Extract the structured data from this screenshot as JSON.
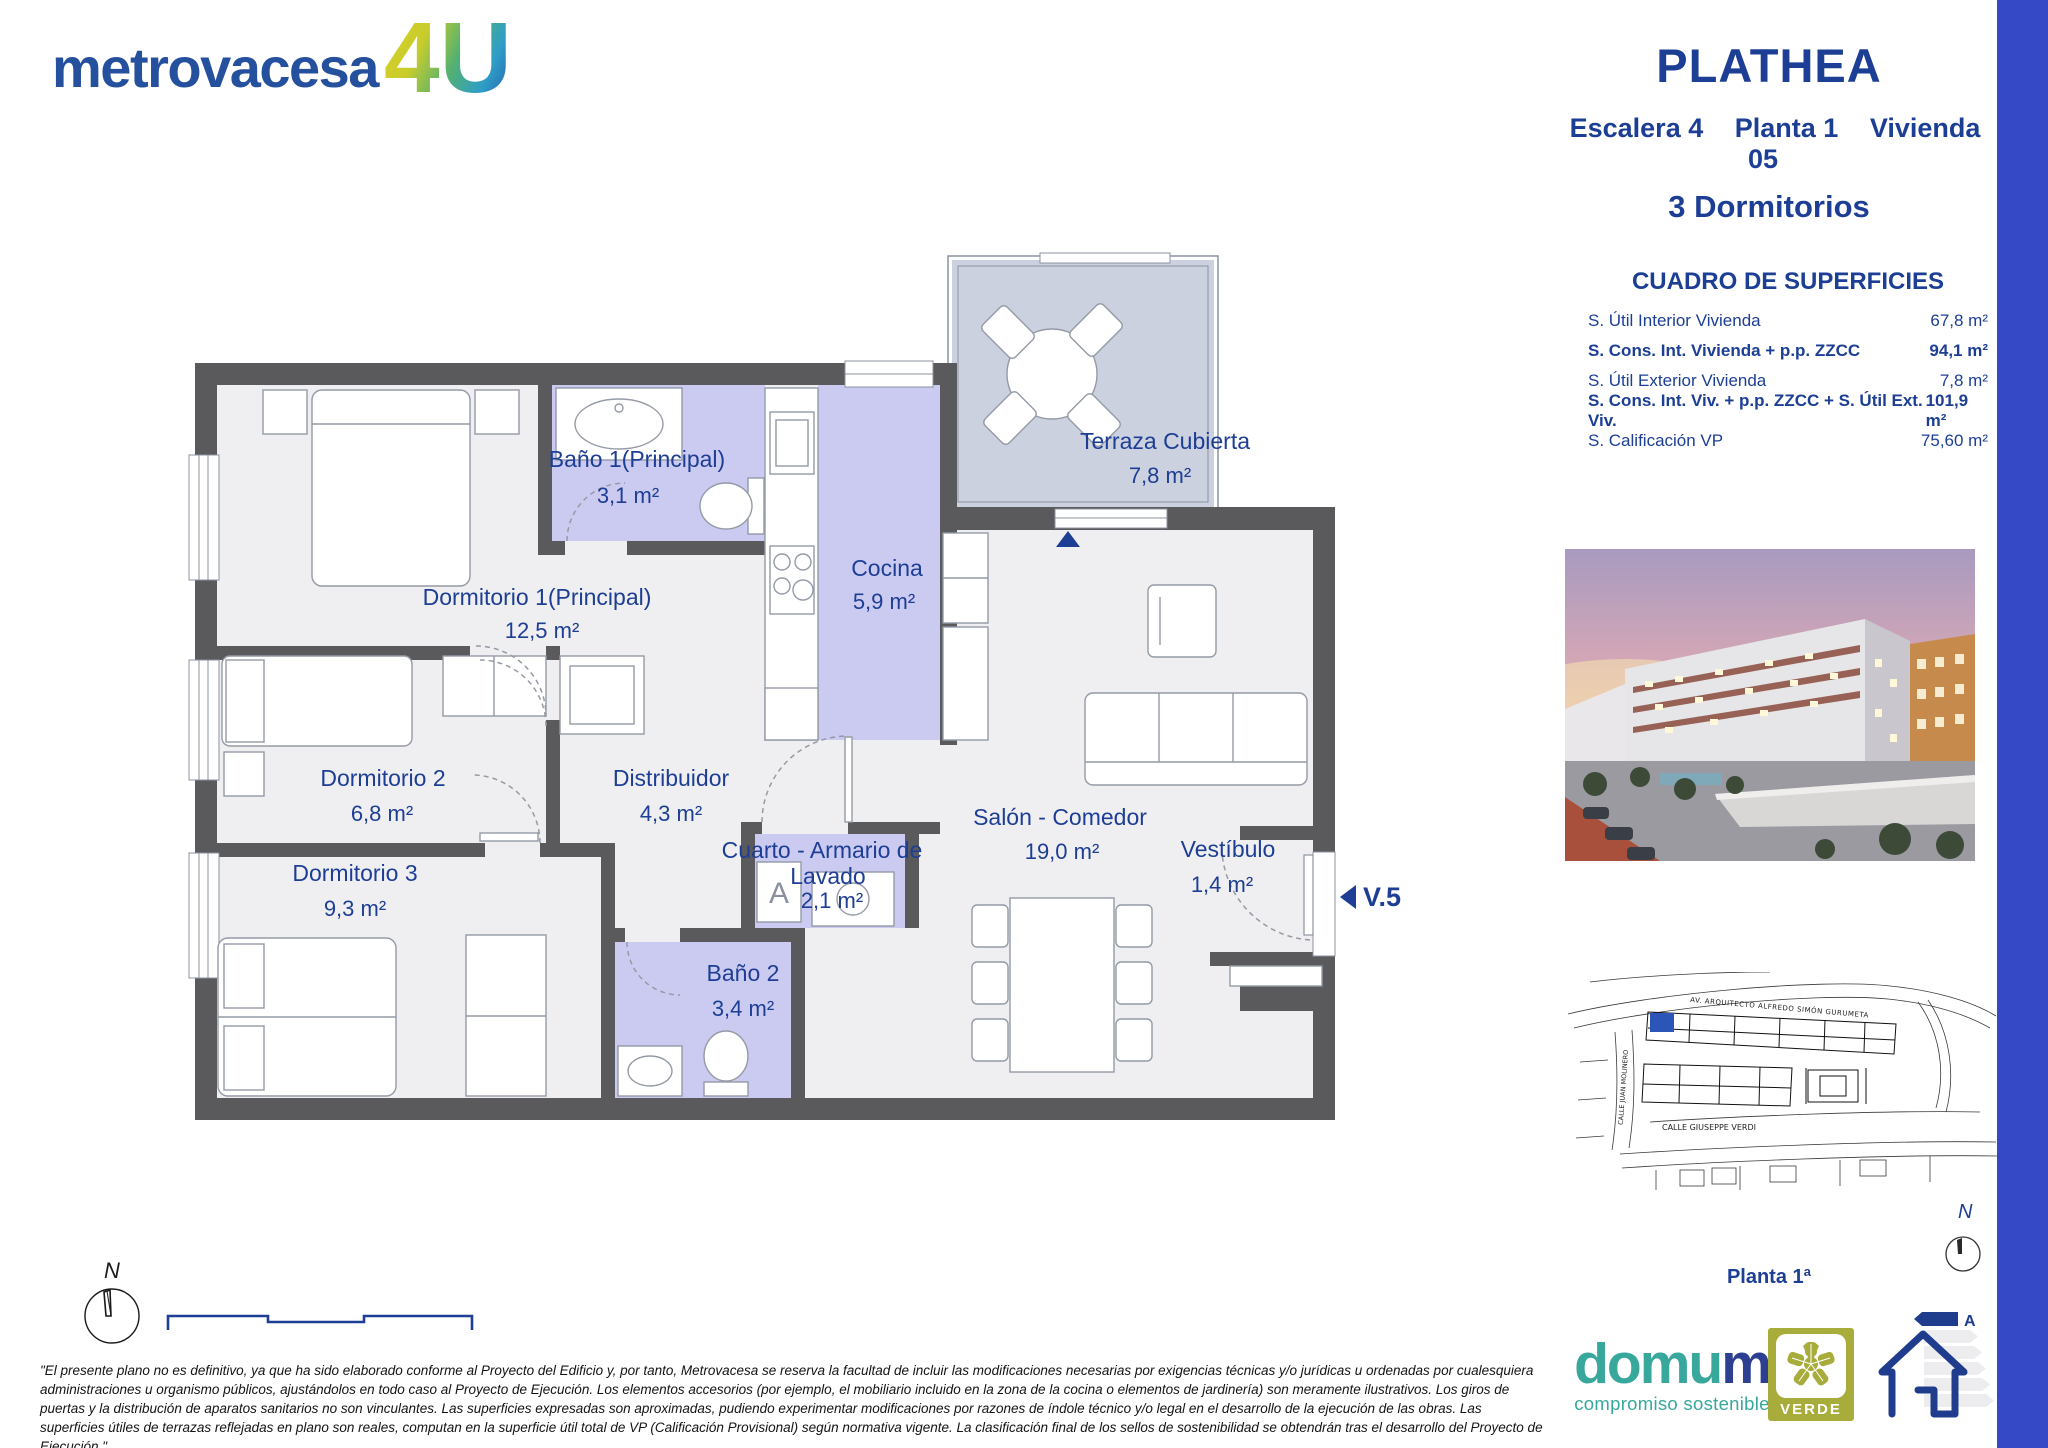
{
  "brand": {
    "name": "metrovacesa",
    "suffix": "4U"
  },
  "header": {
    "project_title": "PLATHEA",
    "escalera": "Escalera 4",
    "planta": "Planta 1",
    "vivienda": "Vivienda 05",
    "bedrooms": "3 Dormitorios"
  },
  "surfaces": {
    "title": "CUADRO DE SUPERFICIES",
    "rows": [
      {
        "label": "S. Útil Interior Vivienda",
        "value": "67,8 m²"
      },
      {
        "label": "S. Cons. Int. Vivienda + p.p. ZZCC",
        "value": "94,1 m²"
      },
      {
        "label": "S. Útil Exterior Vivienda",
        "value": "7,8 m²"
      },
      {
        "label": "S. Cons. Int. Viv. + p.p. ZZCC + S. Útil Ext. Viv.",
        "value": "101,9 m²"
      },
      {
        "label": "S. Calificación VP",
        "value": "75,60 m²"
      }
    ]
  },
  "floorplan": {
    "rooms": [
      {
        "id": "dormitorio-1",
        "lines": [
          "Dormitorio 1(Principal)"
        ],
        "area": "12,5 m²"
      },
      {
        "id": "bano-1",
        "lines": [
          "Baño 1(Principal)"
        ],
        "area": "3,1 m²"
      },
      {
        "id": "terraza",
        "lines": [
          "Terraza Cubierta"
        ],
        "area": "7,8 m²"
      },
      {
        "id": "cocina",
        "lines": [
          "Cocina"
        ],
        "area": "5,9 m²"
      },
      {
        "id": "dormitorio-2",
        "lines": [
          "Dormitorio 2"
        ],
        "area": "6,8 m²"
      },
      {
        "id": "distribuidor",
        "lines": [
          "Distribuidor"
        ],
        "area": "4,3 m²"
      },
      {
        "id": "dormitorio-3",
        "lines": [
          "Dormitorio 3"
        ],
        "area": "9,3 m²"
      },
      {
        "id": "cuarto-lavado",
        "lines": [
          "Cuarto - Armario de",
          "Lavado"
        ],
        "area": "2,1 m²"
      },
      {
        "id": "salon",
        "lines": [
          "Salón - Comedor"
        ],
        "area": "19,0 m²"
      },
      {
        "id": "vestibulo",
        "lines": [
          "Vestíbulo"
        ],
        "area": "1,4 m²"
      },
      {
        "id": "bano-2",
        "lines": [
          "Baño 2"
        ],
        "area": "3,4 m²"
      }
    ],
    "window_marker": "V.5",
    "armario_letter": "A"
  },
  "site_plan": {
    "avenue": "AV. ARQUITECTO ALFREDO SIMÓN GURUMETA",
    "street_left": "CALLE JUAN MOLINERO",
    "street_bottom": "CALLE GIUSEPPE VERDI",
    "caption": "Planta 1ª"
  },
  "compass": {
    "north": "N"
  },
  "disclaimer": {
    "text": "\"El presente plano no es definitivo, ya que ha sido elaborado conforme al Proyecto del Edificio y, por tanto, Metrovacesa se reserva la facultad de incluir las modificaciones necesarias por exigencias técnicas y/o jurídicas u ordenadas por cualesquiera administraciones u organismo públicos, ajustándolos en todo caso al Proyecto de Ejecución. Los elementos accesorios (por ejemplo, el mobiliario incluido en la zona de la cocina o elementos de jardinería) son meramente ilustrativos. Los giros de puertas y la distribución de aparatos sanitarios no son vinculantes. Las superficies expresadas son aproximadas, pudiendo experimentar modificaciones por razones de índole técnico y/o legal en el desarrollo de la ejecución de las obras. Las superficies útiles de terrazas reflejadas en plano son reales, computan en la superficie útil total de VP (Calificación Provisional) según normativa vigente. La clasificación final de los sellos de sostenibilidad se obtendrán tras el desarrollo del Proyecto de Ejecución.\""
  },
  "footer": {
    "domum_text_main": "domu",
    "domum_text_last": "m",
    "domum_tagline": "compromiso sostenible",
    "verde_label": "VERDE",
    "energy_letter": "A"
  },
  "colors": {
    "navy": "#1d3e94",
    "wall_gray": "#5a5a5d",
    "floor": "#efeff1",
    "wet_zone_lavender": "#cbcbf2",
    "terrace_blue_gray": "#ccd1df",
    "side_bar_blue": "#3549c7",
    "domum_teal": "#38a79c",
    "verde_olive": "#a7ac3b"
  }
}
